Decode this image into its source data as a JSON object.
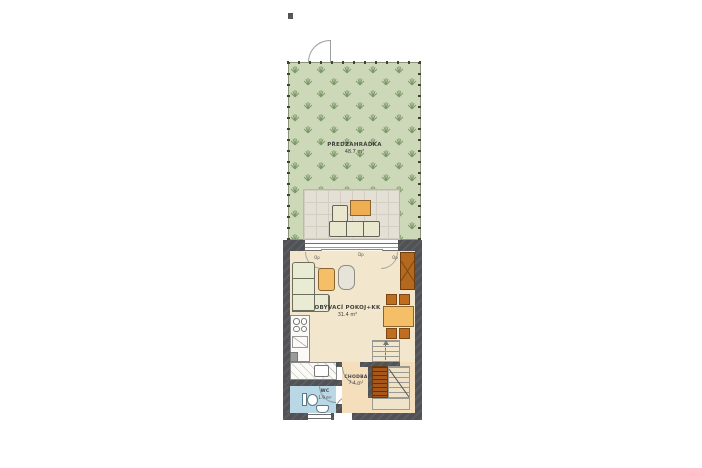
{
  "rooms": {
    "garden": {
      "label": "PŘEDZAHRÁDKA",
      "area": "48.7 m²"
    },
    "living": {
      "label": "OBÝVACÍ POKOJ+KK",
      "area": "31.4 m²"
    },
    "hall": {
      "label": "CHODBA",
      "area": "7.4 m²"
    },
    "wc": {
      "label": "WC",
      "area": "1.9 m²"
    }
  },
  "openings": {
    "left": "Op",
    "middle": "Dp",
    "right": "Op"
  },
  "colors": {
    "garden_green": "#ccd8b8",
    "grass": "#7d9768",
    "terrace": "#e4e0d5",
    "wall_gray": "#55565a",
    "living_floor": "#f2e6cc",
    "hall_floor": "#f4debc",
    "wc_floor": "#bad7e6",
    "accent_orange": "#f5bf68",
    "wood_brown": "#bf6e1f",
    "stair_brown": "#a8571a",
    "outdoor_sofa": "#e9e7ce"
  }
}
